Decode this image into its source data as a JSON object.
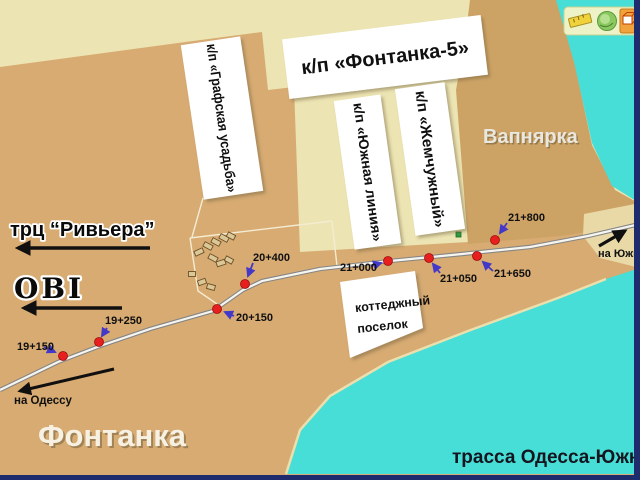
{
  "colors": {
    "land_light": "#ece4b2",
    "land_tan": "#d7ab72",
    "land_tan_dark": "#cda365",
    "sand": "#e9d9a6",
    "water": "#46ded6",
    "frame": "#1e2c6e",
    "marker_red": "#e81f1f",
    "arrow_blue": "#4438c8",
    "box_white": "#ffffff"
  },
  "toolbar": {
    "icons": [
      {
        "name": "ruler"
      },
      {
        "name": "globe"
      },
      {
        "name": "cube"
      }
    ]
  },
  "labels": {
    "fontanka5": "к/п «Фонтанка-5»",
    "grafskaya_usadba": "к/п «Графская усадьба»",
    "yuzhnaya_liniya": "к/п «Южная линия»",
    "zhemchuzhny": "к/п «Жемчужный»",
    "vapnyarka": "Вапнярка",
    "riviera": "трц “Ривьера”",
    "obi": "OBI",
    "fontanka": "Фонтанка",
    "highway": "трасса Одесса-Южный",
    "cottage_line1": "коттеджный",
    "cottage_line2": "поселок",
    "to_odessa": "на Одессу",
    "to_yuzhny": "на Южный"
  },
  "road_markers": [
    {
      "label": "19+150"
    },
    {
      "label": "19+250"
    },
    {
      "label": "20+150"
    },
    {
      "label": "20+400"
    },
    {
      "label": "21+000"
    },
    {
      "label": "21+050"
    },
    {
      "label": "21+650"
    },
    {
      "label": "21+800"
    }
  ]
}
